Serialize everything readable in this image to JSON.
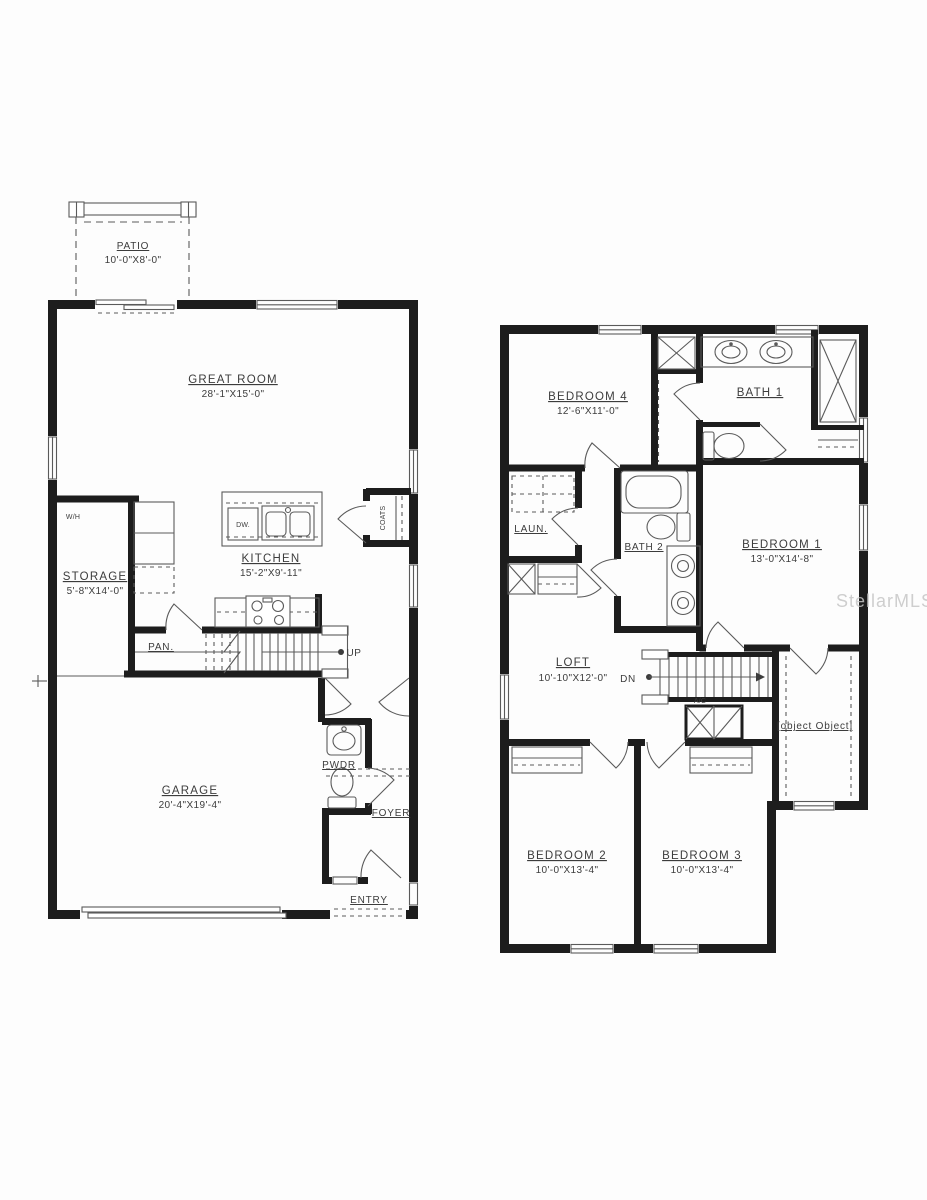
{
  "watermark": "StellarMLS",
  "ff": {
    "patio": {
      "name": "PATIO",
      "dims": "10'-0\"X8'-0\""
    },
    "great_room": {
      "name": "GREAT ROOM",
      "dims": "28'-1\"X15'-0\""
    },
    "kitchen": {
      "name": "KITCHEN",
      "dims": "15'-2\"X9'-11\""
    },
    "storage": {
      "name": "STORAGE",
      "dims": "5'-8\"X14'-0\""
    },
    "garage": {
      "name": "GARAGE",
      "dims": "20'-4\"X19'-4\""
    },
    "pantry": "PAN.",
    "up": "UP",
    "pwdr": "PWDR",
    "foyer": "FOYER",
    "entry": "ENTRY",
    "coats": "COATS",
    "water_heater": "W/H",
    "dishwasher": "DW."
  },
  "sf": {
    "bedroom4": {
      "name": "BEDROOM 4",
      "dims": "12'-6\"X11'-0\""
    },
    "bath1": {
      "name": "BATH 1"
    },
    "bedroom1": {
      "name": "BEDROOM 1",
      "dims": "13'-0\"X14'-8\""
    },
    "laundry": {
      "name": "LAUN."
    },
    "bath2": {
      "name": "BATH 2"
    },
    "loft": {
      "name": "LOFT",
      "dims": "10'-10\"X12'-0\""
    },
    "wic": {
      "name": "W.I.C."
    },
    "bedroom2": {
      "name": "BEDROOM 2",
      "dims": "10'-0\"X13'-4\""
    },
    "bedroom3": {
      "name": "BEDROOM 3",
      "dims": "10'-0\"X13'-4\""
    },
    "dn": "DN",
    "ac": "A/C"
  }
}
